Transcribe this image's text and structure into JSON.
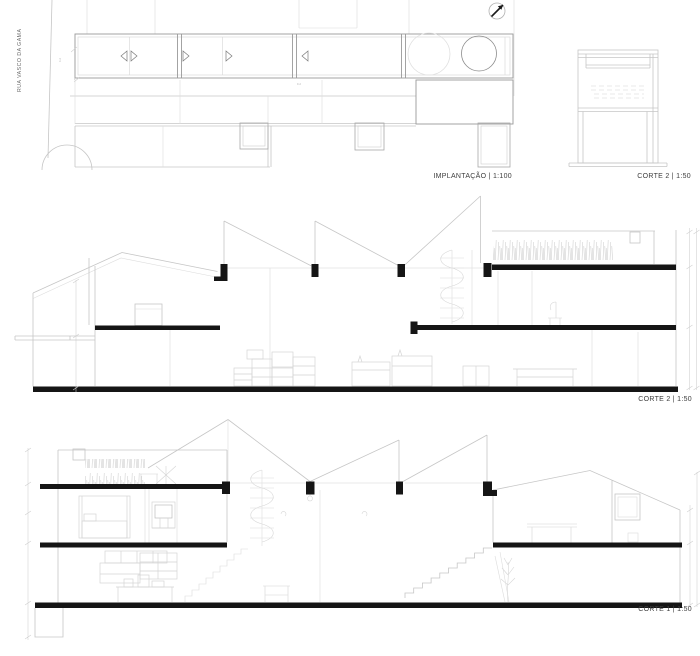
{
  "sheet": {
    "type": "architectural drawing sheet",
    "background": "#ffffff"
  },
  "plan": {
    "label": "IMPLANTAÇÃO | 1:100",
    "street_label": "RUA VASCO DA GAMA",
    "dim_a": "9.2",
    "dim_b": "4.2"
  },
  "section_small": {
    "label": "CORTE 2 | 1:50"
  },
  "section_corte2": {
    "label": "CORTE 2 | 1:50"
  },
  "section_corte1": {
    "label": "CORTE 1 | 1:50"
  },
  "colors": {
    "line_light": "#c6c6c6",
    "line_medium": "#9a9a9a",
    "cut_black": "#151515",
    "label_text": "#3d3d3d",
    "background": "#ffffff"
  }
}
